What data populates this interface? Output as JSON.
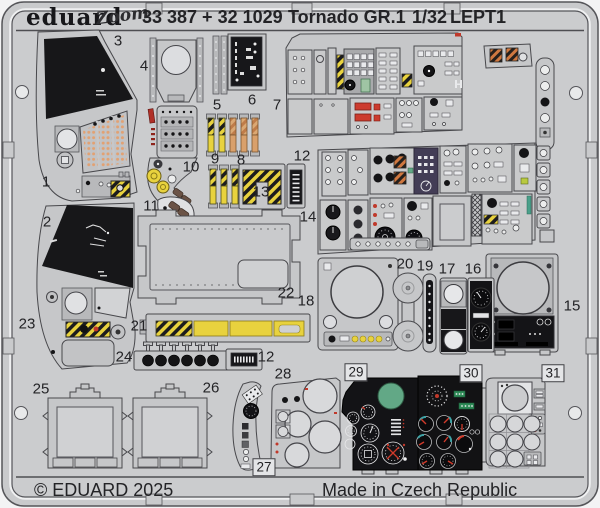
{
  "header": {
    "brand": "eduard",
    "product_line_logo": "Zoom",
    "catalog_numbers": "33 387 + 32 1029",
    "kit_title": "Tornado GR.1",
    "scale": "1/32",
    "sheet_code": "LEPT1"
  },
  "footer": {
    "copyright": "© EDUARD 2025",
    "made_in": "Made in Czech Republic"
  },
  "sheet": {
    "part_labels": [
      "1",
      "2",
      "3",
      "4",
      "5",
      "6",
      "7",
      "8",
      "9",
      "10",
      "11",
      "12",
      "13",
      "14",
      "15",
      "16",
      "17",
      "18",
      "19",
      "20",
      "21",
      "22",
      "23",
      "24",
      "25",
      "26",
      "27",
      "28",
      "29",
      "30",
      "31",
      "12"
    ]
  },
  "colors": {
    "sheet_gray": "#cbccce",
    "hazard_yellow": "#e8d23e",
    "hazard_black": "#1c1c1e",
    "orange_tan": "#d9a06b",
    "panel_black": "#141417",
    "red": "#c0392b",
    "green": "#62a886",
    "teal": "#3fa3a6",
    "lime": "#b9c93f",
    "purple_panel": "#433d56"
  }
}
